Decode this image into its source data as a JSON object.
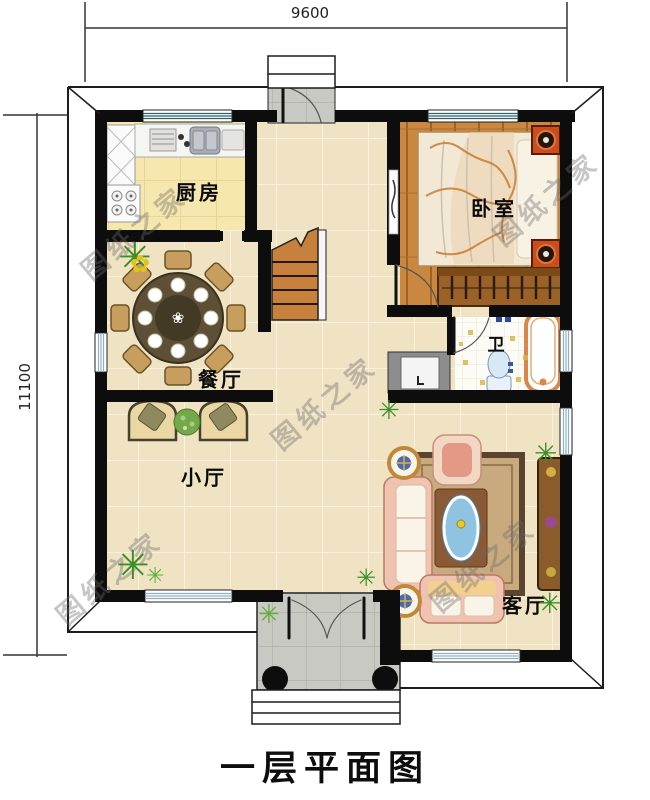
{
  "meta": {
    "title": "一层平面图",
    "type": "architectural floor plan"
  },
  "dimensions": {
    "top": "9600",
    "left": "11100"
  },
  "rooms": {
    "kitchen": {
      "label": "厨房"
    },
    "bedroom": {
      "label": "卧室"
    },
    "dining": {
      "label": "餐厅"
    },
    "bath": {
      "label": "卫"
    },
    "hall": {
      "label": "小厅"
    },
    "living": {
      "label": "客厅"
    }
  },
  "watermark": {
    "text": "图纸之家"
  },
  "icons": {
    "plant": "✳",
    "flower": "✿",
    "table-flower": "❀"
  },
  "colors": {
    "wall": "#0d0d0d",
    "floor_tile": "#efe3c3",
    "kitchen_floor": "#f6e7ae",
    "wood_floor": "#c9873f",
    "porch": "#c9c9c3",
    "window_glass_top": "#2f6268",
    "window_glass_side": "#8fb0c0",
    "nightstand_red": "#cc4c1a",
    "sofa_pink": "#efc3b0",
    "table_blue": "#8ec4e2"
  }
}
